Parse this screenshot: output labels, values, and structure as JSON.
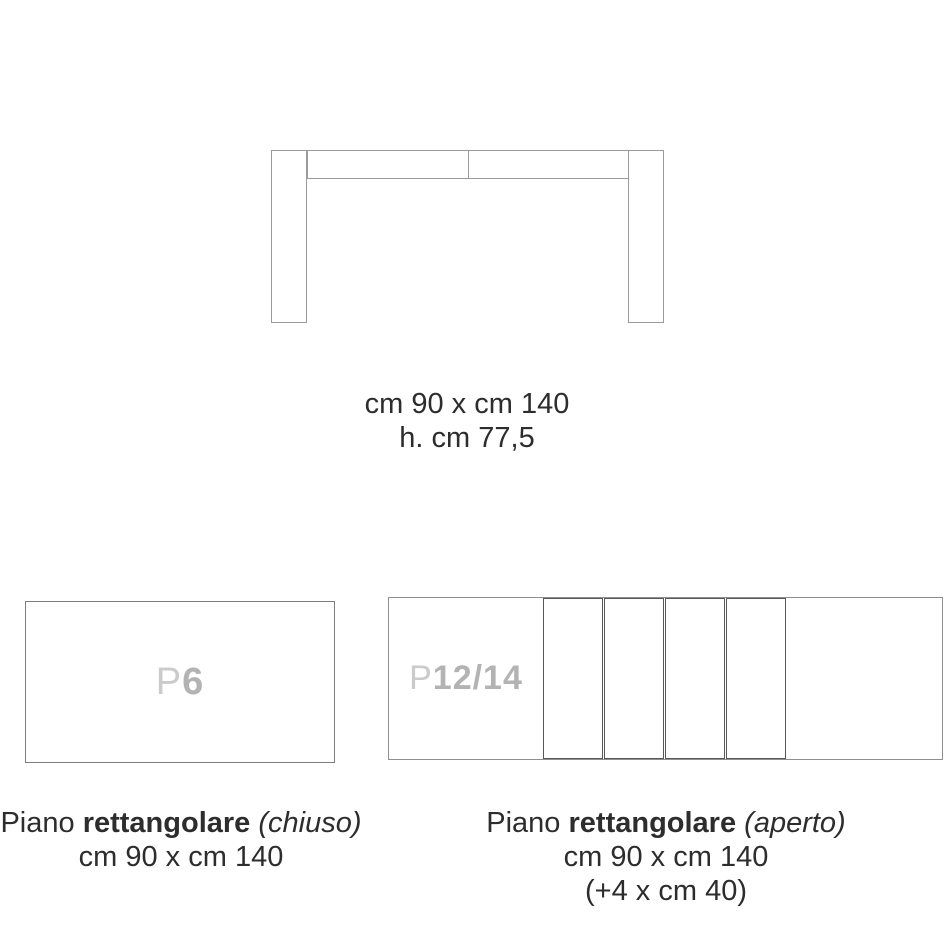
{
  "front_view": {
    "size_label": "cm 90 x cm 140",
    "height_label": "h. cm 77,5"
  },
  "closed_view": {
    "plate_label": {
      "prefix": "P",
      "value": "6"
    },
    "caption": {
      "word_regular": "Piano",
      "word_bold": "rettangolare",
      "word_italic": "(chiuso)",
      "dimensions": "cm 90 x cm 140"
    }
  },
  "open_view": {
    "plate_label": {
      "prefix": "P",
      "value": "12/14"
    },
    "leaf_count": 4,
    "caption": {
      "word_regular": "Piano",
      "word_bold": "rettangolare",
      "word_italic": "(aperto)",
      "dimensions": "cm 90 x cm 140",
      "extension": "(+4 x cm 40)"
    }
  },
  "colors": {
    "drawing_line": "#9b9b9b",
    "leaf_outline": "#585858",
    "plate_label_gray": "#b3b3b3",
    "text_dark": "#2d2d2d"
  }
}
